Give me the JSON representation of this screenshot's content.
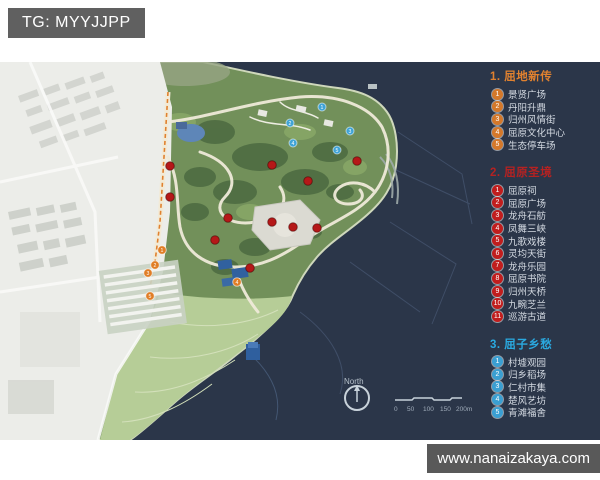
{
  "page": {
    "tag_label": "TG: MYYJJPP",
    "watermark": "www.nanaizakaya.com"
  },
  "legend": {
    "sections": [
      {
        "title": "1. 屈地新传",
        "title_color": "#e0812f",
        "circle_color": "#d4782a",
        "items": [
          {
            "n": "1",
            "label": "景贤广场"
          },
          {
            "n": "2",
            "label": "丹阳升鼎"
          },
          {
            "n": "3",
            "label": "归州风情街"
          },
          {
            "n": "4",
            "label": "屈原文化中心"
          },
          {
            "n": "5",
            "label": "生态停车场"
          }
        ]
      },
      {
        "title": "2. 屈原圣境",
        "title_color": "#b42222",
        "circle_color": "#c11d1d",
        "items": [
          {
            "n": "1",
            "label": "屈原祠"
          },
          {
            "n": "2",
            "label": "屈原广场"
          },
          {
            "n": "3",
            "label": "龙舟石舫"
          },
          {
            "n": "4",
            "label": "凤舞三峡"
          },
          {
            "n": "5",
            "label": "九歌戏楼"
          },
          {
            "n": "6",
            "label": "灵均天街"
          },
          {
            "n": "7",
            "label": "龙舟乐园"
          },
          {
            "n": "8",
            "label": "屈原书院"
          },
          {
            "n": "9",
            "label": "归州天桥"
          },
          {
            "n": "10",
            "label": "九畹芝兰"
          },
          {
            "n": "11",
            "label": "巡游古道"
          }
        ]
      },
      {
        "title": "3. 屈子乡愁",
        "title_color": "#2aa9e0",
        "circle_color": "#3a9fd2",
        "items": [
          {
            "n": "1",
            "label": "村墟观园"
          },
          {
            "n": "2",
            "label": "归乡稻场"
          },
          {
            "n": "3",
            "label": "仁村市集"
          },
          {
            "n": "4",
            "label": "楚风艺坊"
          },
          {
            "n": "5",
            "label": "青滩福舍"
          }
        ]
      }
    ]
  },
  "map": {
    "north_label": "North",
    "scale_labels": [
      "0",
      "50",
      "100",
      "150",
      "200m"
    ],
    "markers": {
      "red": [
        [
          170,
          104
        ],
        [
          170,
          135
        ],
        [
          228,
          156
        ],
        [
          272,
          103
        ],
        [
          308,
          119
        ],
        [
          357,
          99
        ],
        [
          272,
          160
        ],
        [
          293,
          165
        ],
        [
          317,
          166
        ],
        [
          250,
          206
        ],
        [
          215,
          178
        ]
      ],
      "blue": [
        [
          322,
          45,
          "1"
        ],
        [
          290,
          61,
          "2"
        ],
        [
          350,
          69,
          "3"
        ],
        [
          293,
          81,
          "4"
        ],
        [
          337,
          88,
          "5"
        ]
      ],
      "orange": [
        [
          162,
          188,
          "1"
        ],
        [
          155,
          203,
          "2"
        ],
        [
          148,
          211,
          "3"
        ],
        [
          237,
          220,
          "4"
        ],
        [
          150,
          234,
          "5"
        ]
      ]
    }
  }
}
